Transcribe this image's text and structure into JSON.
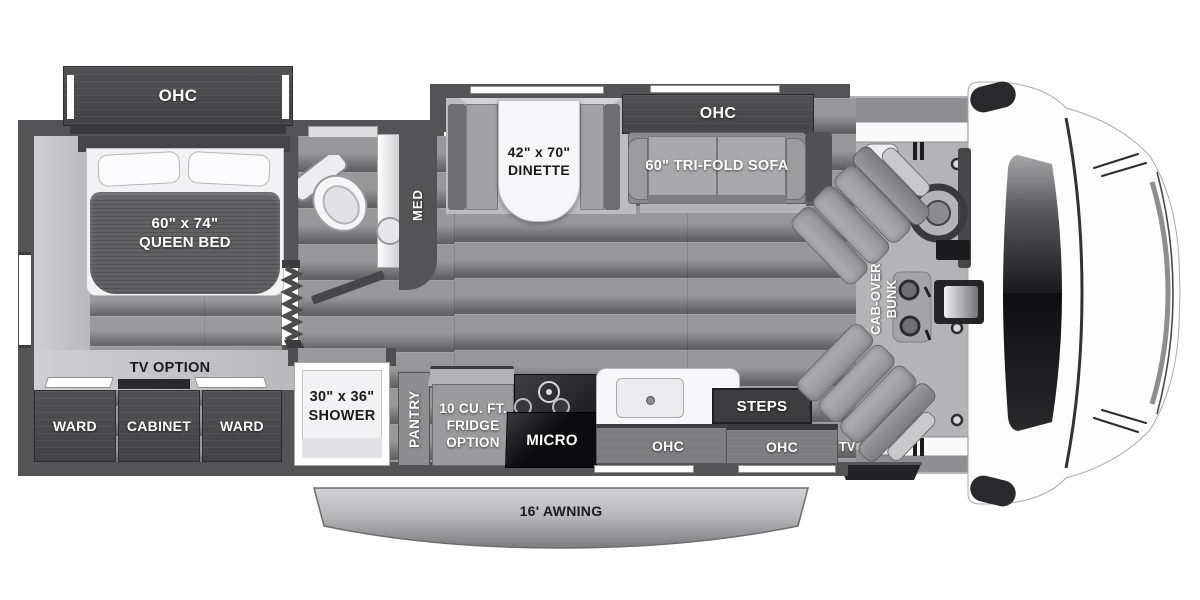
{
  "colors": {
    "wall": "#545457",
    "cabinet_dark": "#4a4a4d",
    "floor_wood": "#98989a",
    "carpet": "#c6c6c8",
    "box_gray": "#7d7d7f",
    "steps_dark": "#3c3c3e",
    "windshield": "#121214",
    "awning_top": "#cdcdcf",
    "awning_bottom": "#7f7f81",
    "label_white": "#ffffff",
    "label_dark": "#1a1a1c"
  },
  "bedroom": {
    "ohc": "OHC",
    "bed_size": "60\" x 74\"",
    "bed_type": "QUEEN BED",
    "tv_option": "TV OPTION",
    "ward_left": "WARD",
    "cabinet": "CABINET",
    "ward_right": "WARD"
  },
  "bathroom": {
    "med": "MED"
  },
  "dinette": {
    "size": "42\" x 70\"",
    "name": "DINETTE"
  },
  "sofa": {
    "ohc": "OHC",
    "label": "60\" TRI-FOLD SOFA"
  },
  "kitchen": {
    "shower_size": "30\" x 36\"",
    "shower": "SHOWER",
    "pantry": "PANTRY",
    "fridge_line1": "10 CU. FT.",
    "fridge_line2": "FRIDGE",
    "fridge_line3": "OPTION",
    "micro": "MICRO",
    "ohc": "OHC"
  },
  "entry": {
    "steps": "STEPS",
    "ohc": "OHC",
    "tv": "TV"
  },
  "cab": {
    "bunk_line1": "CAB-OVER",
    "bunk_line2": "BUNK"
  },
  "exterior": {
    "awning": "16' AWNING"
  }
}
